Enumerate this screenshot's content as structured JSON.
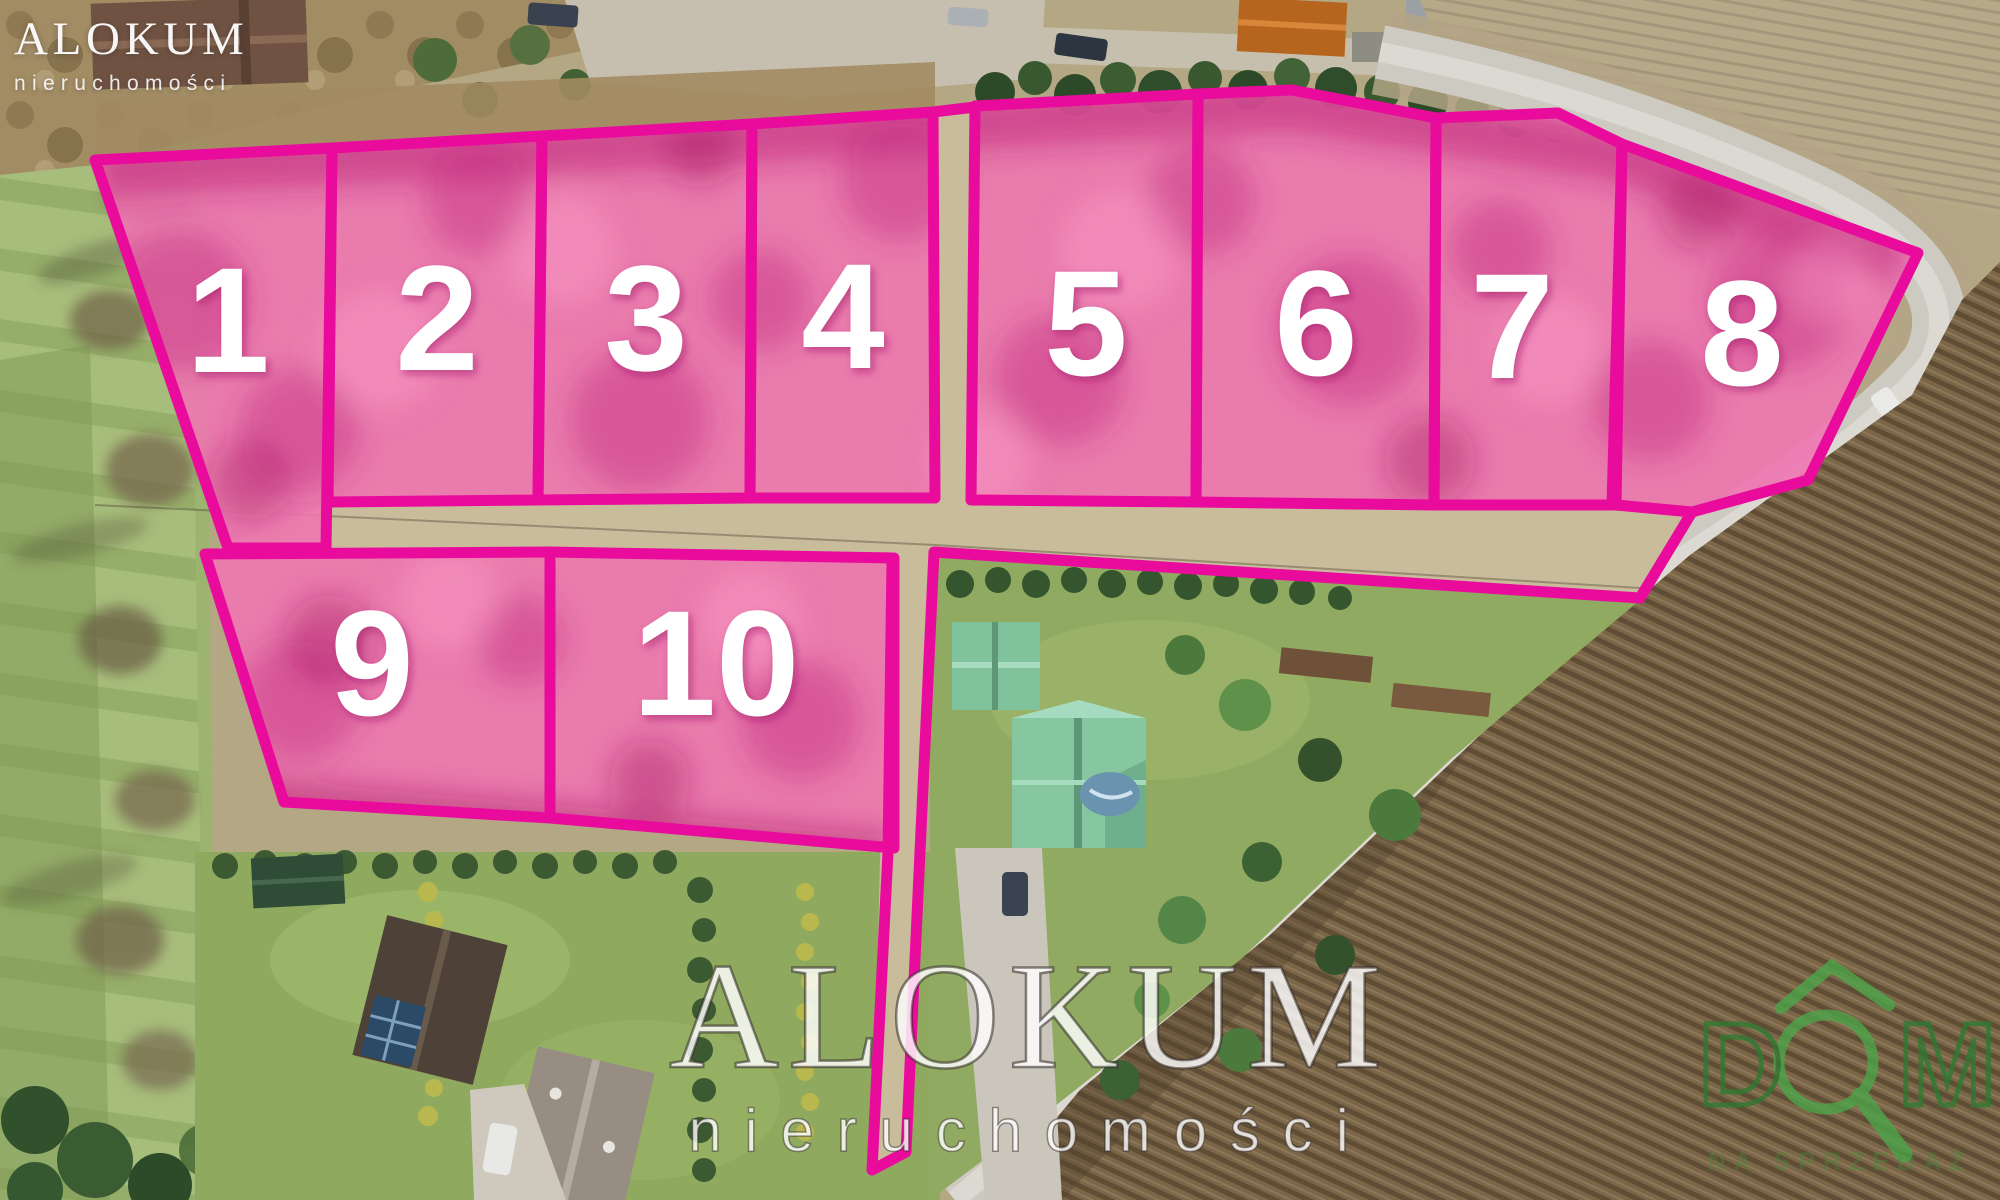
{
  "branding": {
    "logo_top_left": {
      "title": "ALOKUM",
      "subtitle": "nieruchomości"
    },
    "watermark_center": {
      "title": "ALOKUM",
      "subtitle": "nieruchomości"
    },
    "logo_bottom_right": {
      "text": "DOM",
      "tagline": "NA SPRZEDAŻ"
    }
  },
  "colors": {
    "plot_border": "#e90c9c",
    "plot_fill": "#ee77b1",
    "number_color": "#ffffff",
    "logo_green": "#3f8f3c"
  },
  "plots": [
    {
      "id": "plot-1",
      "label": "1"
    },
    {
      "id": "plot-2",
      "label": "2"
    },
    {
      "id": "plot-3",
      "label": "3"
    },
    {
      "id": "plot-4",
      "label": "4"
    },
    {
      "id": "plot-5",
      "label": "5"
    },
    {
      "id": "plot-6",
      "label": "6"
    },
    {
      "id": "plot-7",
      "label": "7"
    },
    {
      "id": "plot-8",
      "label": "8"
    },
    {
      "id": "plot-9",
      "label": "9"
    },
    {
      "id": "plot-10",
      "label": "10"
    }
  ]
}
